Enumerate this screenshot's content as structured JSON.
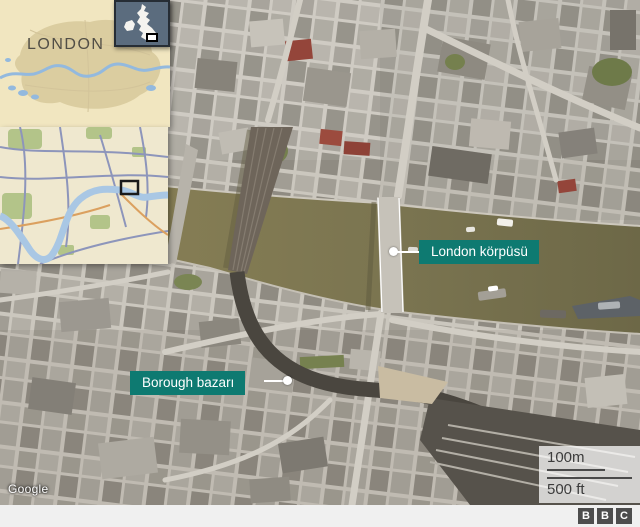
{
  "insets": {
    "london_map": {
      "title": "LONDON"
    },
    "uk_map": {
      "description": "uk-locator-map"
    },
    "street_map": {
      "description": "central-london-street-map"
    }
  },
  "labels": {
    "london_bridge": "London körpüsü",
    "borough_market": "Borough bazarı"
  },
  "scale": {
    "metric": "100m",
    "imperial": "500 ft"
  },
  "attribution": "Google",
  "bbc_logo": {
    "letters": [
      "B",
      "B",
      "C"
    ]
  },
  "colors": {
    "label_teal": "#0e7a71",
    "river_olive": "#7a7450",
    "inset_beige": "#f1e6c0",
    "uk_inset_slate": "#5b6c7e",
    "scale_text": "#3c3c3c"
  }
}
